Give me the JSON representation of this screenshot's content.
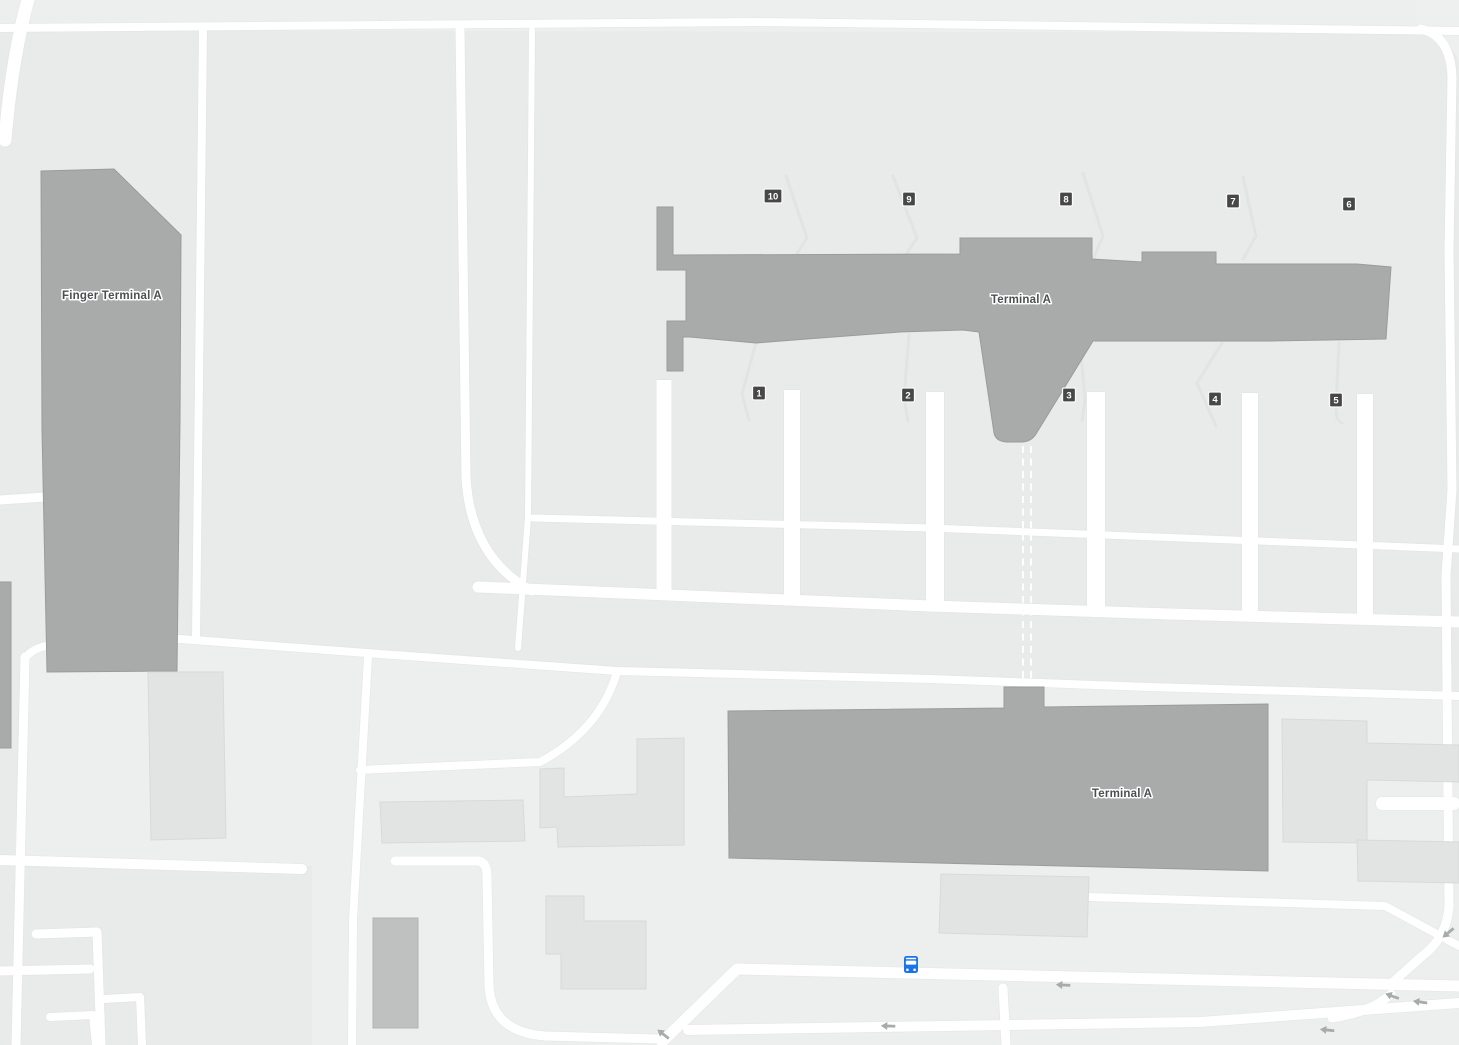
{
  "buildings": {
    "finger_terminal_a": {
      "label": "Finger Terminal A"
    },
    "terminal_a_upper": {
      "label": "Terminal A"
    },
    "terminal_a_lower": {
      "label": "Terminal A"
    }
  },
  "gates": {
    "1": "1",
    "2": "2",
    "3": "3",
    "4": "4",
    "5": "5",
    "6": "6",
    "7": "7",
    "8": "8",
    "9": "9",
    "10": "10"
  },
  "transit": {
    "bus_stop_icon": "bus-icon"
  },
  "road_markings": {
    "one_way_arrow_icon": "left-arrow-icon"
  },
  "colors": {
    "background": "#edefee",
    "parcel": "#e9ebea",
    "road": "#ffffff",
    "building_dark": "#a9abaa",
    "building_light": "#e2e4e3",
    "gate_badge": "#474747",
    "gate_badge_text": "#ffffff",
    "label_text": "#4c4f52",
    "bus_blue": "#1a73e8",
    "arrow_gray": "#a7abaa"
  }
}
